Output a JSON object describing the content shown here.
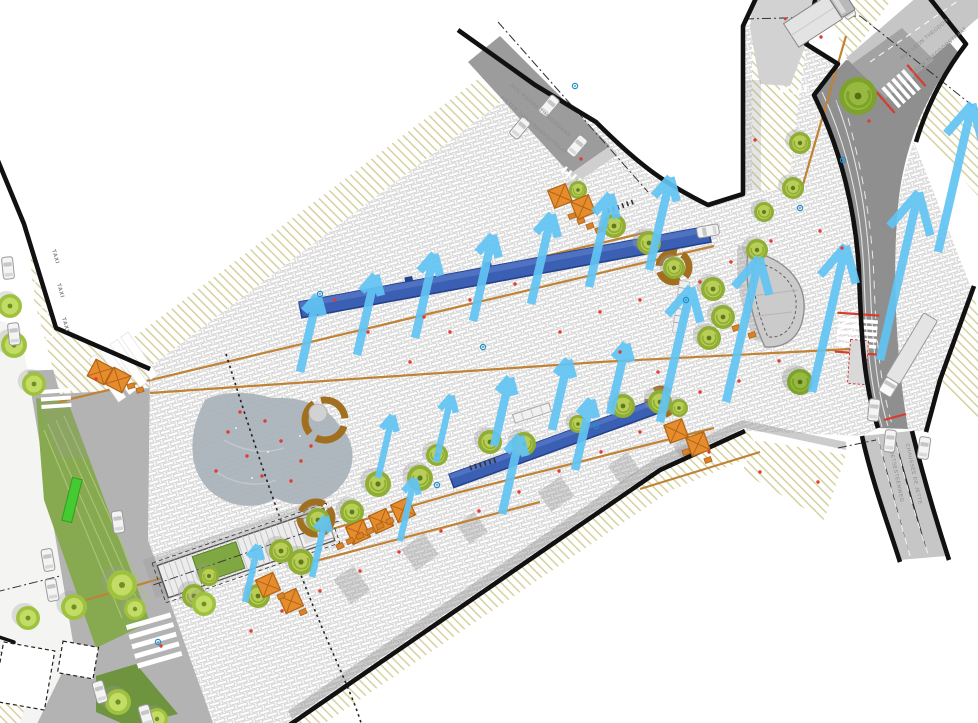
{
  "plan": {
    "labels": {
      "taxi": "TAXI",
      "side_street_fr": "RUE PIERRE TIMMERMANS",
      "side_street_nl": "PIETER TIMMERMANSSTRAAT",
      "north_street_fr": "RUE LÉON THEODOR",
      "north_street_nl": "LÉON THEODORSTRAAT",
      "southeast_street_fr": "CHAUSSÉE DE JETTE",
      "southeast_street_nl": "JETSESTEENWEG"
    },
    "colors": {
      "flow_arrow": "#62c3f3",
      "linear_bench": "#3b5fb2",
      "linear_bench_dark": "#24418c",
      "tree_outer": "#8fae33",
      "tree_inner": "#b9ce59",
      "tree_bright_outer": "#9fc23e",
      "tree_bright_inner": "#c3dc66",
      "tree_dark_outer": "#7da32c",
      "tree_dark_inner": "#97b93f",
      "parasol": "#e78c2d",
      "parasol_edge": "#b06516",
      "table": "#d9822a",
      "circular_bench": "#a06f1f",
      "water": "#a9b2ba",
      "lawn": "#87a94f",
      "lawn_dark": "#6f9440",
      "bright_bench": "#45cb31",
      "road": "#8f8f8f",
      "road_light": "#c6c6c6",
      "hatch": "#d4d09a",
      "paving_joint": "#cfcfcf",
      "marker_red": "#e23b30",
      "marker_blue": "#1e8ec8",
      "drainage_line": "#c08234",
      "building_line": "#111111",
      "crosswalk_red": "#d93a2e"
    }
  }
}
